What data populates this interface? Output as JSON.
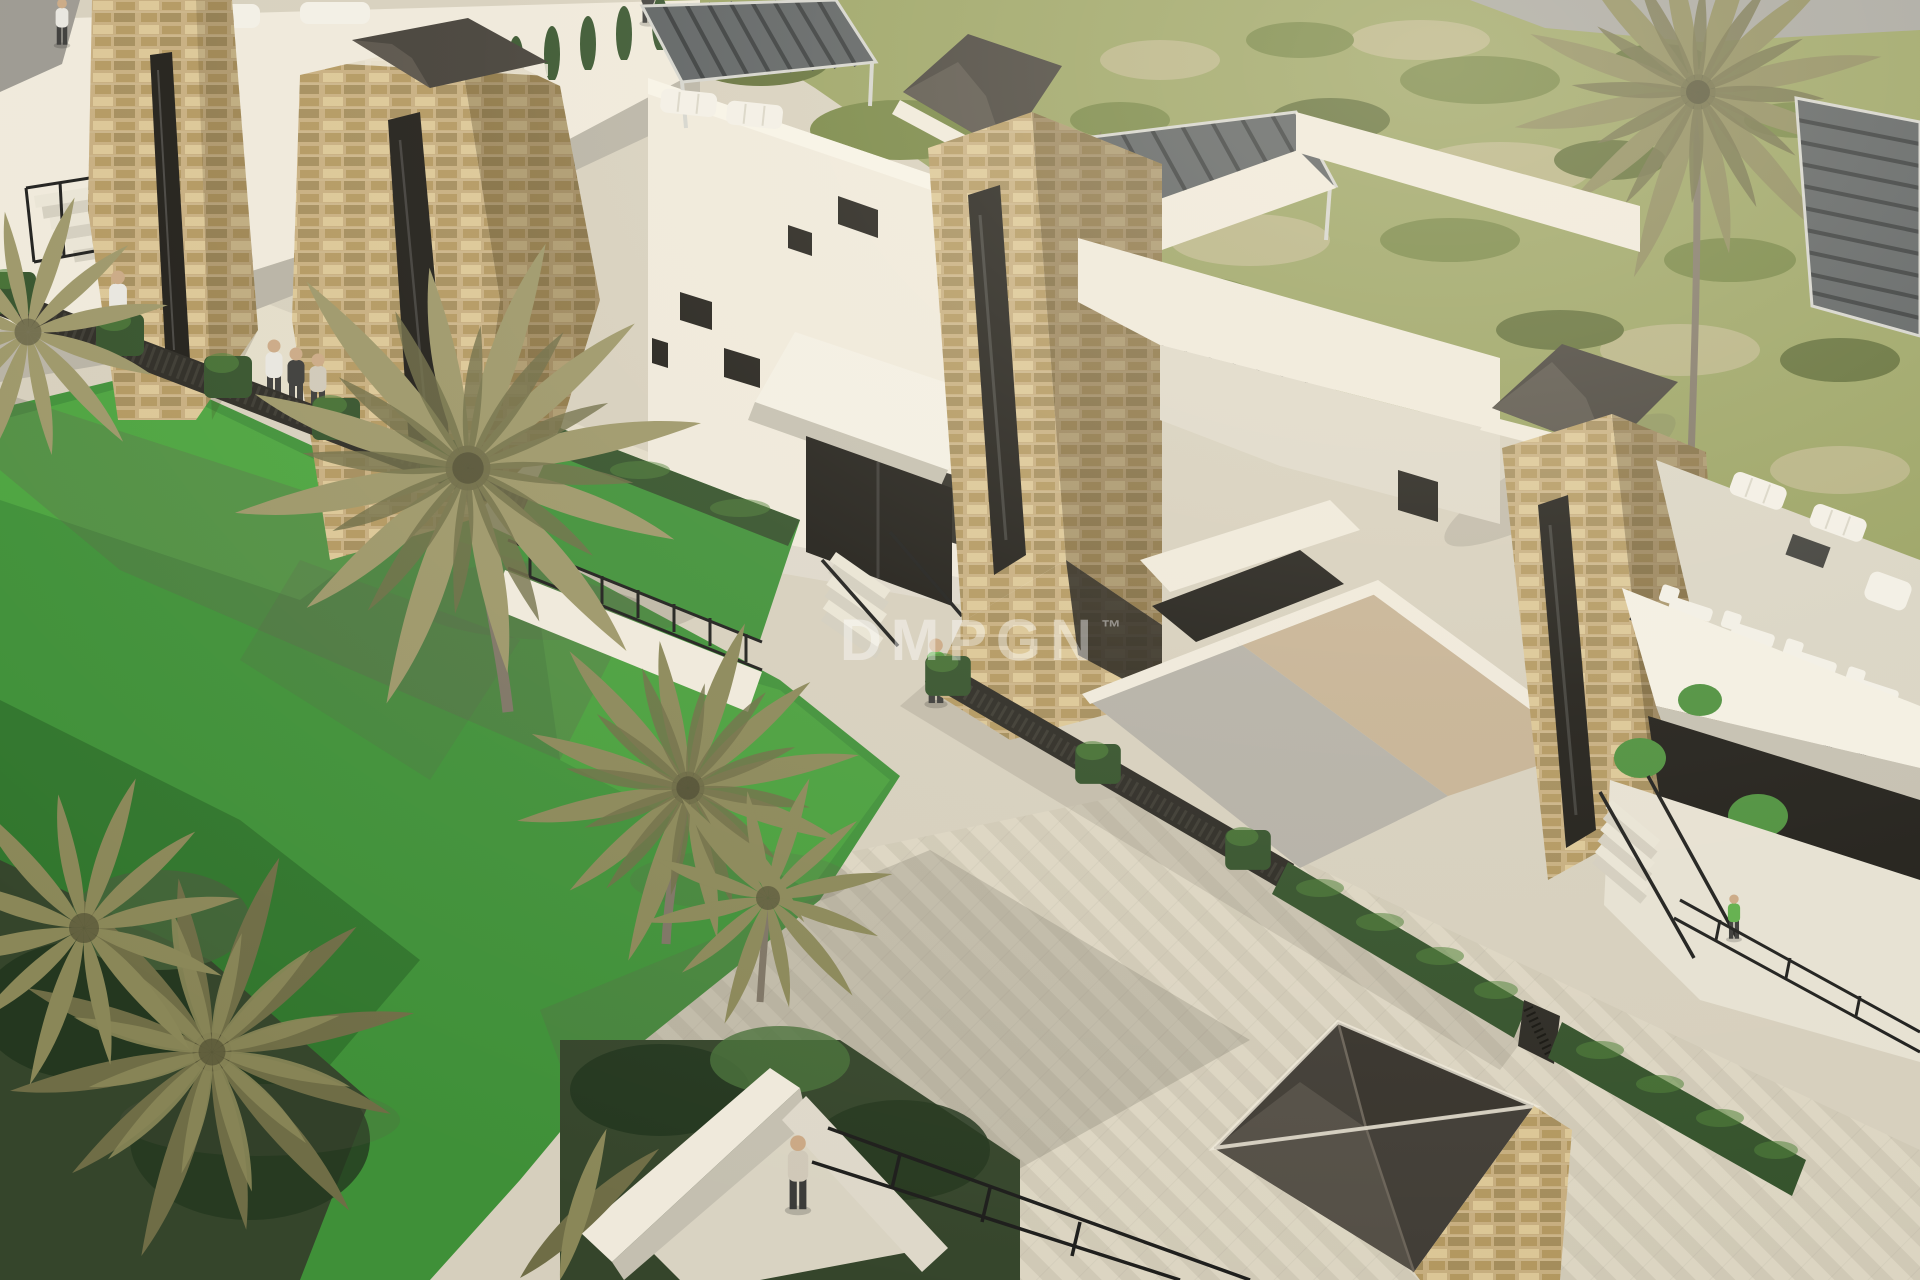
{
  "meta": {
    "title": "Villa development aerial render",
    "alt": "Aerial 3D architectural render of a modern villa complex with sand-stone towers topped by dark glass pyramid skylights, white flat-roof villas with slatted pergolas and rooftop lounge furniture, box hedges, black metal stairs and railings, a cream paved promenade, a palm-filled garden on the left, open olive-green scrubland on the upper right, and small people figures walking through the scene."
  },
  "watermark": {
    "text": "DMPGN",
    "tm": "™"
  },
  "palette": {
    "c_pave": "#d6cfbd",
    "c_pave_light": "#e3dcc9",
    "c_pave_sh": "#b6b1a2",
    "c_herr_a": "#cfc8b5",
    "c_herr_b": "#ddd6c3",
    "c_white_lit": "#efe9db",
    "c_white_mid": "#ded8c9",
    "c_white_sh": "#b7b2a4",
    "c_roof_gray": "#9b9890",
    "c_stone_a": "#c6ad7e",
    "c_stone_b": "#b2975f",
    "c_stone_c": "#dbc695",
    "c_stone_d": "#97814f",
    "c_glass_dark": "#403c35",
    "c_glass_mid": "#5a544b",
    "c_slat": "#555a5c",
    "c_slat_dark": "#2e3234",
    "c_frame_light": "#d3d3cd",
    "c_field": "#97a05f",
    "c_field_patch": "#b7b184",
    "c_bush_dark": "#5d6b33",
    "c_bush_mid": "#72823f",
    "c_grass": "#3f9038",
    "c_grass_lit": "#4da53f",
    "c_grass_dark": "#2e6f2a",
    "c_hedge": "#33512a",
    "c_hedge_lit": "#4f8238",
    "c_fence_dark": "#2b2923",
    "c_palm1": "#9c9668",
    "c_palm2": "#8a8758",
    "c_palm3": "#6f6d46",
    "c_trunk": "#7d7464",
    "c_tree_dark": "#35452b",
    "c_tree_deep": "#24371f",
    "c_road": "#a3a29c",
    "c_opening": "#1e1c17",
    "c_rail": "#1d1d1b",
    "c_furn": "#f2efe6",
    "c_wood": "#c9b183",
    "c_shadow": "#5f5a4c",
    "c_skin": "#caa884",
    "c_cloth_dark": "#3a3a38",
    "c_cloth_white": "#e8e6e0",
    "c_cloth_green": "#5fae4a",
    "c_cloth_beige": "#cfc8b8",
    "c_awning": "#f3efe3",
    "c_awning_sh": "#c4bfb0",
    "c_ramp_gray": "#b4b0a6",
    "c_ramp_beige": "#c6b294",
    "c_wm": "#ffffff"
  }
}
